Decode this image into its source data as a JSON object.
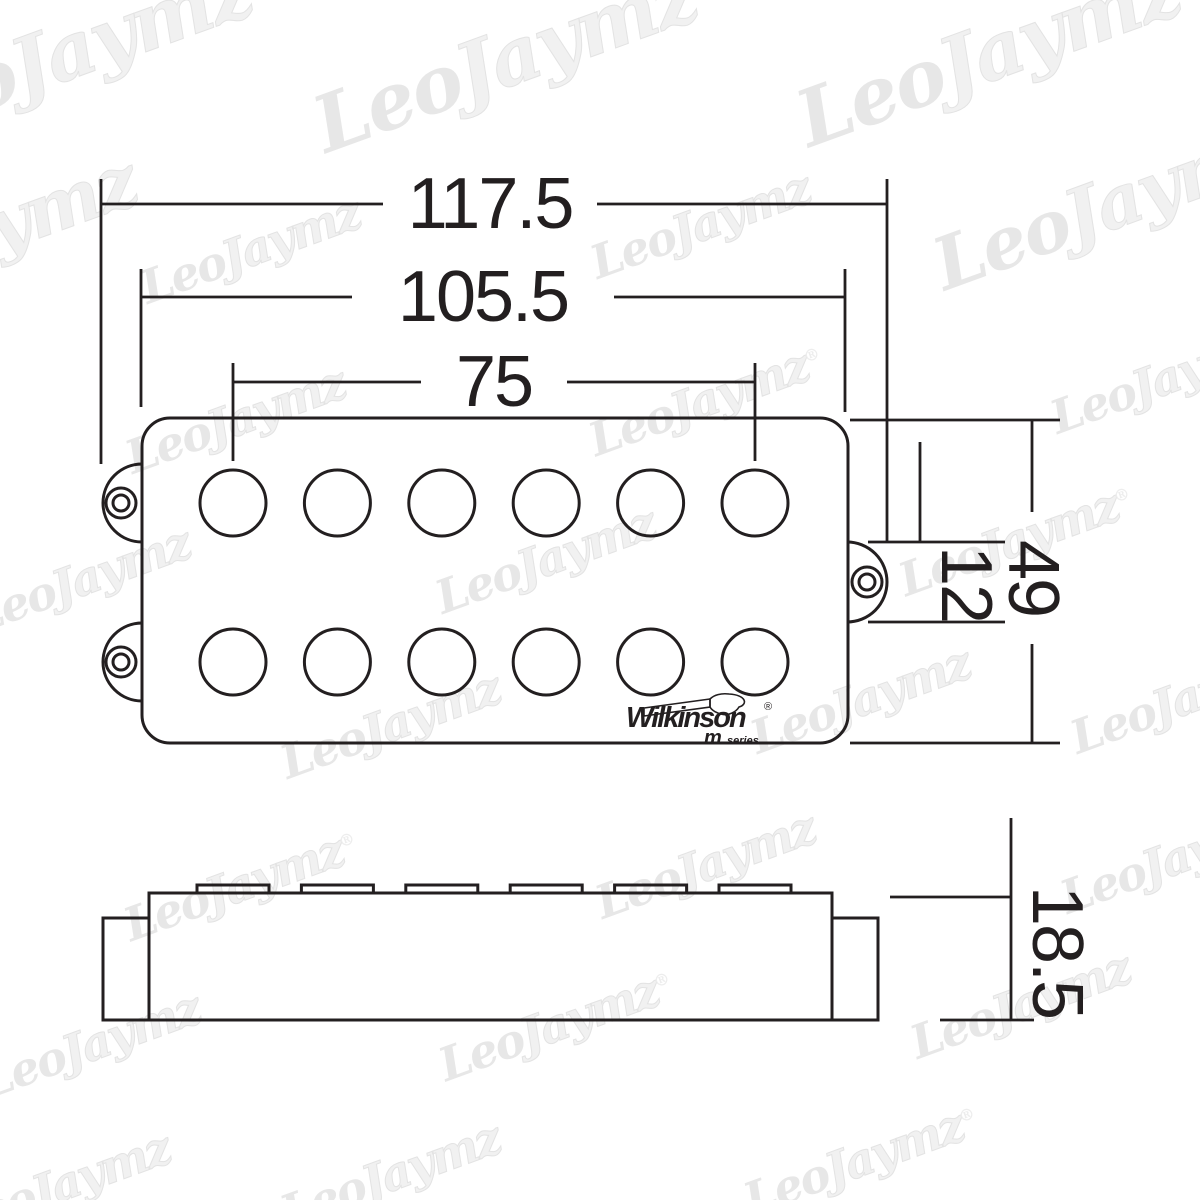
{
  "title": "Pickup dimension drawing",
  "dims": {
    "overall_width": "117.5",
    "body_width": "105.5",
    "pole_span": "75",
    "body_height": "49",
    "ear_height": "12",
    "side_height": "18.5"
  },
  "logo": {
    "brand": "Wilkinson",
    "registered": "®",
    "series_m": "m",
    "series": "series"
  },
  "colors": {
    "line": "#231f20",
    "background": "#ffffff",
    "watermark_fill": "#e7e7e7",
    "watermark_outline": "#e3e3e3"
  },
  "watermark": {
    "leo": "Leo",
    "jaymz": "Jaymz",
    "reg": "®",
    "tiles": [
      {
        "x": 60,
        "y": 55,
        "s": 78,
        "reg": false
      },
      {
        "x": 505,
        "y": 60,
        "s": 78,
        "reg": false
      },
      {
        "x": 1000,
        "y": 50,
        "s": 78,
        "reg": true
      },
      {
        "x": -40,
        "y": 240,
        "s": 72,
        "reg": false
      },
      {
        "x": 1120,
        "y": 200,
        "s": 72,
        "reg": true
      },
      {
        "x": 250,
        "y": 250,
        "s": 46,
        "reg": false
      },
      {
        "x": 700,
        "y": 225,
        "s": 46,
        "reg": false
      },
      {
        "x": 235,
        "y": 420,
        "s": 46,
        "reg": false
      },
      {
        "x": 705,
        "y": 400,
        "s": 46,
        "reg": true
      },
      {
        "x": 1160,
        "y": 380,
        "s": 46,
        "reg": false
      },
      {
        "x": 80,
        "y": 580,
        "s": 46,
        "reg": false
      },
      {
        "x": 545,
        "y": 560,
        "s": 46,
        "reg": false
      },
      {
        "x": 1015,
        "y": 540,
        "s": 46,
        "reg": true
      },
      {
        "x": 390,
        "y": 725,
        "s": 46,
        "reg": false
      },
      {
        "x": 860,
        "y": 700,
        "s": 46,
        "reg": false
      },
      {
        "x": 1180,
        "y": 700,
        "s": 46,
        "reg": false
      },
      {
        "x": 240,
        "y": 885,
        "s": 46,
        "reg": true
      },
      {
        "x": 705,
        "y": 865,
        "s": 46,
        "reg": false
      },
      {
        "x": 1170,
        "y": 860,
        "s": 46,
        "reg": false
      },
      {
        "x": 90,
        "y": 1045,
        "s": 46,
        "reg": false
      },
      {
        "x": 555,
        "y": 1025,
        "s": 46,
        "reg": true
      },
      {
        "x": 1020,
        "y": 1005,
        "s": 46,
        "reg": false
      },
      {
        "x": 390,
        "y": 1175,
        "s": 46,
        "reg": false
      },
      {
        "x": 860,
        "y": 1160,
        "s": 46,
        "reg": true
      },
      {
        "x": 60,
        "y": 1185,
        "s": 46,
        "reg": false
      }
    ]
  }
}
